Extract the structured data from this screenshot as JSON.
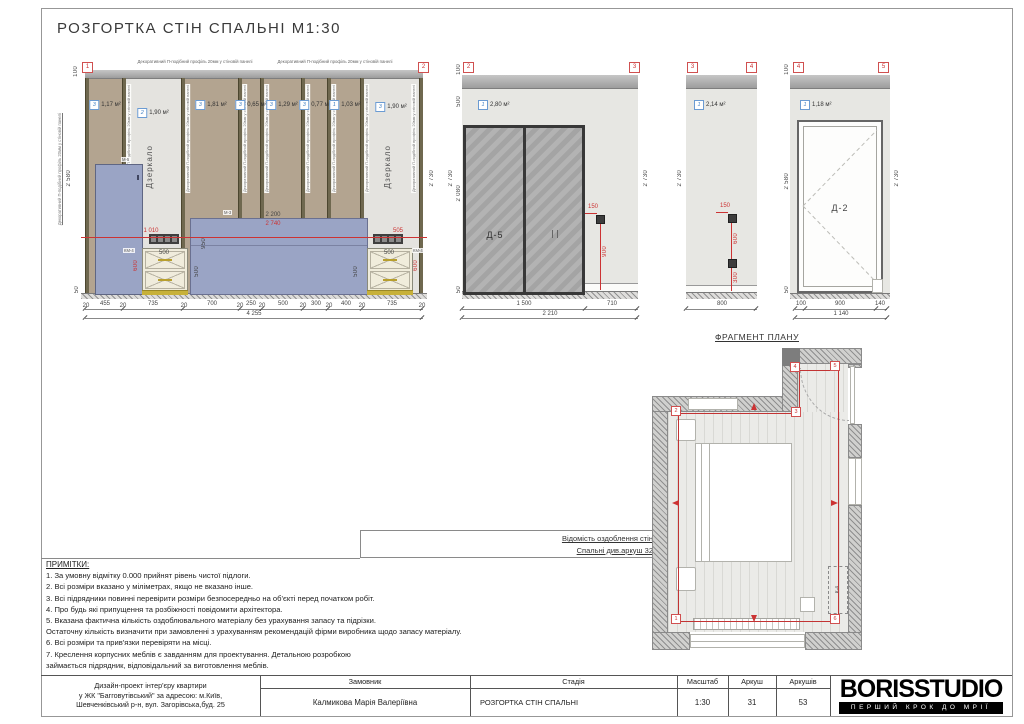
{
  "sheet": {
    "title": "РОЗГОРТКА СТІН СПАЛЬНІ М1:30"
  },
  "common": {
    "profile_note": "Декоративний П-подібний профіль 20мм у стіновій панелі",
    "mirror": "Дзеркало",
    "height_total": "2 730",
    "height_main": "2 580",
    "top_gap": "100",
    "floor_gap": "50"
  },
  "el1": {
    "marker_left": "1",
    "marker_right": "2",
    "panels": [
      {
        "code": "3",
        "area": "1,17 м²"
      },
      {
        "code": "2",
        "area": "1,90 м²"
      },
      {
        "code": "3",
        "area": "1,81 м²"
      },
      {
        "code": "3",
        "area": "0,65 м²"
      },
      {
        "code": "3",
        "area": "1,29 м²"
      },
      {
        "code": "3",
        "area": "0,77 м²"
      },
      {
        "code": "1",
        "area": "1,03 м²"
      },
      {
        "code": "3",
        "area": "1,90 м²"
      }
    ],
    "furniture": {
      "wardrobe": "М-5",
      "bed": "М-3",
      "nightstand_left": "КМ-4",
      "nightstand_right": "КМ-4",
      "nightstand_width": "500"
    },
    "dims_red": {
      "left": "1 010",
      "center": "2 740",
      "right": "505",
      "nightstand_height": "600"
    },
    "dims_black": {
      "bed_width": "2 200",
      "bed_height": "950",
      "side_left": "500",
      "side_right": "500"
    },
    "dims_bottom": [
      "20",
      "455",
      "20",
      "735",
      "20",
      "700",
      "20",
      "250",
      "20",
      "500",
      "20",
      "300",
      "20",
      "400",
      "20",
      "735",
      "20"
    ],
    "dim_total": "4 255"
  },
  "el2": {
    "marker_left": "2",
    "marker_right": "3",
    "code": "1",
    "area": "2,80 м²",
    "door": "Д-5",
    "dims_left": [
      "100",
      "500",
      "2 080",
      "50"
    ],
    "socket_offset": "150",
    "socket_height": "900",
    "dims_bottom": [
      "1 500",
      "710"
    ],
    "dim_total": "2 210"
  },
  "el3": {
    "marker_left": "3",
    "marker_right": "4",
    "code": "1",
    "area": "2,14 м²",
    "socket_offset": "150",
    "socket_gap": "600",
    "socket_height": "300",
    "dim_bottom": "800"
  },
  "el4": {
    "marker_left": "4",
    "marker_right": "5",
    "code": "1",
    "area": "1,18 м²",
    "door": "Д-2",
    "dims_bottom": [
      "100",
      "900",
      "140"
    ],
    "dim_total": "1 140"
  },
  "plan": {
    "title": "ФРАГМЕНТ ПЛАНУ",
    "markers": [
      "1",
      "2",
      "3",
      "4",
      "5",
      "6"
    ],
    "unit": "К-4"
  },
  "finish_table": {
    "line1": "Відомість оздоблення стін",
    "line2": "Спальні див.аркуш 32"
  },
  "notes": {
    "title": "ПРИМІТКИ:",
    "lines": [
      "1. За умовну відмітку 0.000 прийнят рівень чистої підлоги.",
      "2. Всі розміри вказано у міліметрах, якщо не вказано інше.",
      "3. Всі підрядники повинні перевірити розміри безпосередньо на об'єкті перед початком робіт.",
      "4. Про будь які припущення та розбіжності повідомити архітектора.",
      "5. Вказана фактична кількість оздоблювального матеріалу без урахування запасу та підрізки.",
      "Остаточну кількість визначити при замовленні з урахуванням рекомендацій фірми виробника щодо запасу матеріалу.",
      "6. Всі розміри та прив'язки перевіряти на місці.",
      "7. Креслення корпусних меблів є завданням для проектування. Детальною розробкою",
      "займається підрядник, відповідальний за виготовлення меблів."
    ]
  },
  "titleblock": {
    "project_line1": "Дизайн-проект інтер'єру квартири",
    "project_line2": "у ЖК \"Багговутівський\" за адресою: м.Київ,",
    "project_line3": "Шевченківський р-н, вул. Загорівська,буд. 25",
    "client_label": "Замовник",
    "client_value": "Калмикова Марія Валеріївна",
    "stage_label": "Стадія",
    "stage_value": "РОЗГОРТКА СТІН СПАЛЬНІ",
    "scale_label": "Масштаб",
    "scale_value": "1:30",
    "sheet_label": "Аркуш",
    "sheet_value": "31",
    "sheets_label": "Аркушів",
    "sheets_value": "53",
    "logo": "BORISSTUDIO",
    "slogan": "ПЕРШИЙ КРОК ДО МРІЇ"
  }
}
